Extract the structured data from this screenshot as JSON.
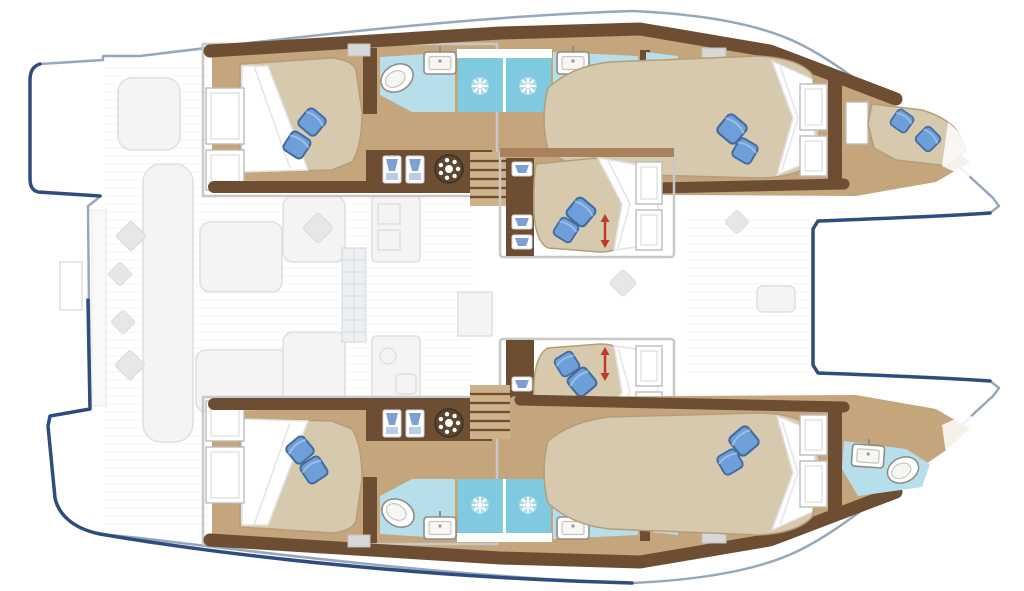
{
  "colors": {
    "hull_fill": "#ffffff",
    "hull_stroke": "#97a7bd",
    "navy": "#2e4d7e",
    "wood_dark": "#6e4e33",
    "wood_mid": "#9c7850",
    "floor_tan": "#c4a57c",
    "bed_tan": "#d7c9ae",
    "bed_edge": "#b39e79",
    "duvet": "#ffffff",
    "duvet_shadow": "#e2e2e2",
    "pillow": "#6f9fd8",
    "pillow_dark": "#426c9e",
    "pillow_light": "#a8c4e8",
    "bath": "#b6dfeb",
    "shower": "#7fcadf",
    "fixture_stroke": "#8d8d84",
    "faded_fill": "#ededed",
    "faded_stroke": "#cccccc",
    "arrow_red": "#c0392b",
    "drawer_blue": "#7d9fd4"
  },
  "legend": {
    "vessel": "sailing catamaran floor plan",
    "orientation": "bow to the right",
    "hulls": [
      "port (top)",
      "starboard (bottom)"
    ],
    "cabins": [
      {
        "id": "port-aft-cabin",
        "berth": "double",
        "pillows": 2
      },
      {
        "id": "port-forward-cabin",
        "berth": "double",
        "pillows": 2
      },
      {
        "id": "port-bow-crew-cabin",
        "berth": "single",
        "pillows": 2
      },
      {
        "id": "center-upper-cabin",
        "berth": "double",
        "pillows": 2,
        "note": "red extension arrow"
      },
      {
        "id": "center-lower-cabin",
        "berth": "double",
        "pillows": 2,
        "note": "red extension arrow"
      },
      {
        "id": "starboard-aft-cabin",
        "berth": "double",
        "pillows": 2
      },
      {
        "id": "starboard-forward-cabin",
        "berth": "double",
        "pillows": 2
      }
    ],
    "bathrooms": [
      {
        "id": "port-bathroom",
        "toilets": 1,
        "sinks": 2,
        "shower_stalls": 2
      },
      {
        "id": "starboard-bathroom",
        "toilets": 1,
        "sinks": 2,
        "shower_stalls": 2
      },
      {
        "id": "starboard-bow-head",
        "toilets": 1,
        "sinks": 1
      }
    ],
    "deck_features_faded": [
      "helm-seat",
      "aft-cockpit-benches",
      "cockpit-tables",
      "saloon-sofas",
      "galley-counters",
      "companionway-grid",
      "forward-cockpit-seat",
      "bow-trampoline"
    ],
    "counts": {
      "blue_pillows": 14,
      "gray_cushions": 7,
      "stairs": 2,
      "wardrobe_lockers": 4,
      "washing_machines": 2,
      "shower_stalls": 4
    }
  }
}
